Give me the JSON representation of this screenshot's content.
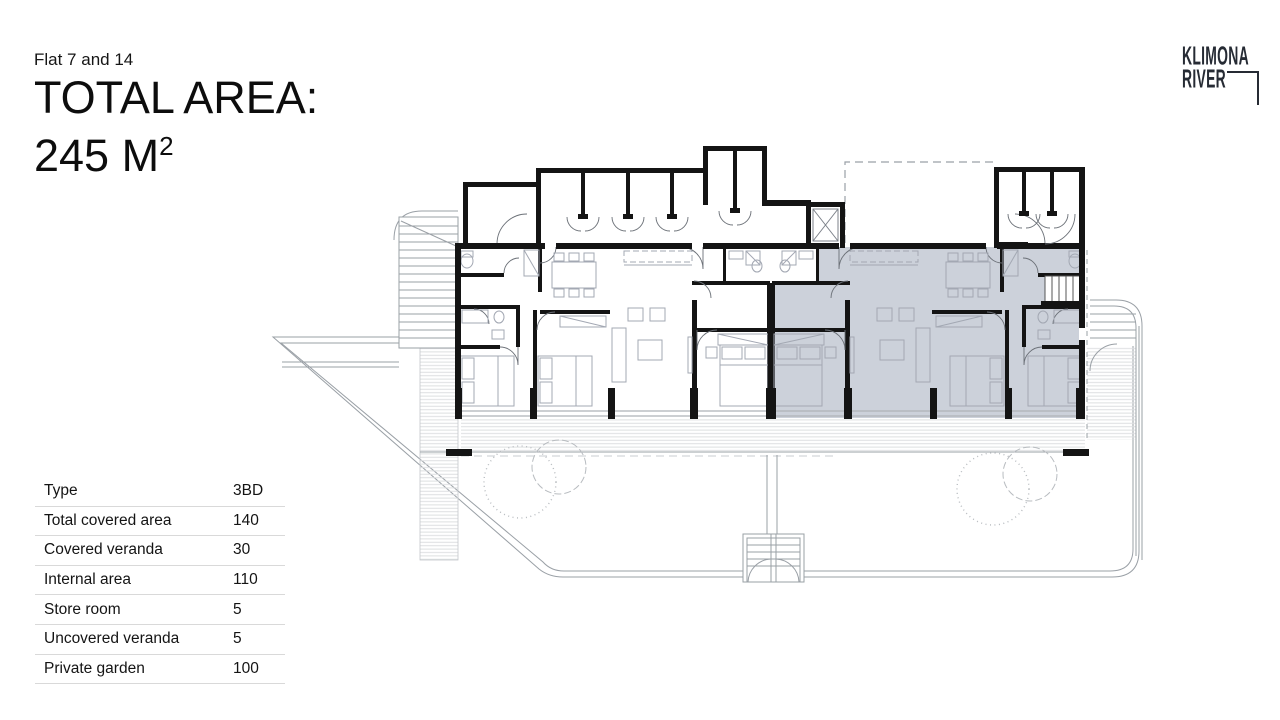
{
  "header": {
    "subtitle": "Flat 7 and 14",
    "title_line1": "TOTAL AREA:",
    "area_value": "245 M",
    "area_superscript": "2"
  },
  "logo": {
    "line1": "KLIMONA",
    "line2": "RIVER"
  },
  "table": {
    "rows": [
      {
        "label": "Type",
        "value": "3BD"
      },
      {
        "label": "Total covered area",
        "value": "140"
      },
      {
        "label": "Covered veranda",
        "value": "30"
      },
      {
        "label": "Internal area",
        "value": "110"
      },
      {
        "label": "Store room",
        "value": "5"
      },
      {
        "label": "Uncovered veranda",
        "value": "5"
      },
      {
        "label": "Private garden",
        "value": "100"
      }
    ]
  },
  "plan": {
    "highlighted_unit": "Flat 7 and 14",
    "highlight_fill": "#ccd1da",
    "wall_color": "#141414",
    "thin_line_color": "#9aa0a6",
    "furniture_color": "#a3a8b3"
  },
  "colors": {
    "background": "#ffffff",
    "logo": "#262b34",
    "text": "#111111",
    "table_divider": "#d9d9d9"
  }
}
